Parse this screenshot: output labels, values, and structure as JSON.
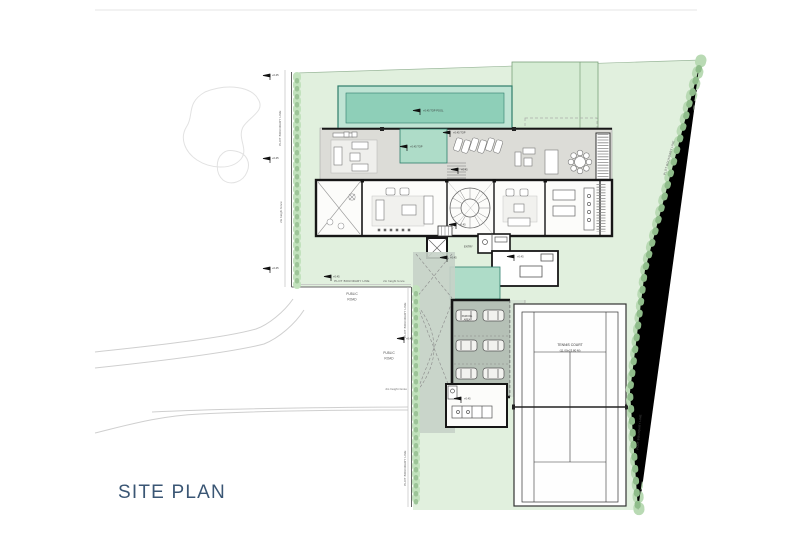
{
  "title": {
    "text": "SITE PLAN"
  },
  "labels": {
    "plot_boundary_line": "PLOT BOUNDARY LINE",
    "fence_note": "2m height fence",
    "public_road_line1": "PUBLIC",
    "public_road_line2": "ROAD",
    "pool_level": "+0.45 TOP POOL",
    "deck_level": "+0.45 TOP",
    "level_mark": "+0.45",
    "entry": "ENTRY",
    "parking_line1": "PARKING",
    "parking_line2": "AREA",
    "tennis_court_name": "TENNIS COURT",
    "tennis_court_dim": "(11.00x23.80 M)"
  },
  "colors": {
    "title": "#3a5674",
    "plot_green": "#e1f0de",
    "pool_teal": "#8ecfb8",
    "pool_rim": "#2e7d6b",
    "deck_gray": "#dcdcd7",
    "drive_gray": "#c7d1c8",
    "garage_gray": "#b5c0b6",
    "hedge_green": "#b9dab4",
    "wall_black": "#161616"
  },
  "icons": {
    "level_flag": "level-flag-icon",
    "tree": "tree-icon",
    "car": "car-icon",
    "spiral_stair": "spiral-stair-icon"
  }
}
